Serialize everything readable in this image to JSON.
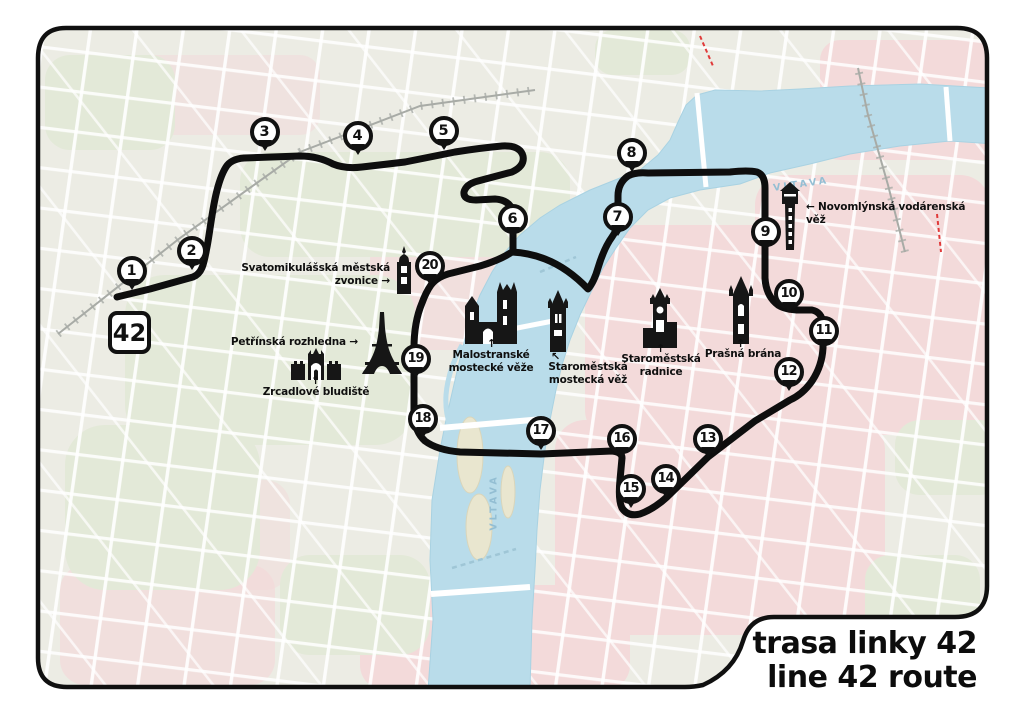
{
  "badge": {
    "label": "42"
  },
  "title": {
    "line1": "trasa linky 42",
    "line2": "line 42 route"
  },
  "river": {
    "name_top": "VLTAVA",
    "name_bottom": "VLTAVA"
  },
  "stops": [
    {
      "n": "1",
      "x": 132,
      "y": 271
    },
    {
      "n": "2",
      "x": 192,
      "y": 251
    },
    {
      "n": "3",
      "x": 265,
      "y": 132
    },
    {
      "n": "4",
      "x": 358,
      "y": 136
    },
    {
      "n": "5",
      "x": 444,
      "y": 131
    },
    {
      "n": "6",
      "x": 513,
      "y": 219
    },
    {
      "n": "7",
      "x": 618,
      "y": 217
    },
    {
      "n": "8",
      "x": 632,
      "y": 153
    },
    {
      "n": "9",
      "x": 766,
      "y": 232
    },
    {
      "n": "10",
      "x": 789,
      "y": 294
    },
    {
      "n": "11",
      "x": 824,
      "y": 331
    },
    {
      "n": "12",
      "x": 789,
      "y": 372
    },
    {
      "n": "13",
      "x": 708,
      "y": 439
    },
    {
      "n": "14",
      "x": 666,
      "y": 479
    },
    {
      "n": "15",
      "x": 631,
      "y": 489
    },
    {
      "n": "16",
      "x": 622,
      "y": 439
    },
    {
      "n": "17",
      "x": 541,
      "y": 431
    },
    {
      "n": "18",
      "x": 423,
      "y": 419
    },
    {
      "n": "19",
      "x": 416,
      "y": 359
    },
    {
      "n": "20",
      "x": 430,
      "y": 266
    }
  ],
  "landmarks": [
    {
      "id": "zvonice",
      "label": "Svatomikulášská městská zvonice →"
    },
    {
      "id": "petrin",
      "label": "Petřínská rozhledna →"
    },
    {
      "id": "bludiste",
      "arrow": "↑",
      "label": "Zrcadlové bludiště"
    },
    {
      "id": "malostranske",
      "arrow": "↑",
      "label": "Malostranské\nmostecké věže"
    },
    {
      "id": "mostecka",
      "arrow": "↖",
      "label": "Staroměstská\nmostecká věž"
    },
    {
      "id": "radnice",
      "arrow": "↑",
      "label": "Staroměstská\nradnice"
    },
    {
      "id": "prasna",
      "arrow": "↑",
      "label": "Prašná brána"
    },
    {
      "id": "vodarenska",
      "label": "← Novomlýnská vodárenská věž"
    }
  ],
  "colors": {
    "route": "#0e0e0e",
    "border": "#101010",
    "river": "#b9dcea",
    "map_base": "#ecece4",
    "parks": "#e3e9d8",
    "blocks": "#f3dada",
    "accent_red": "#e03a3a"
  }
}
